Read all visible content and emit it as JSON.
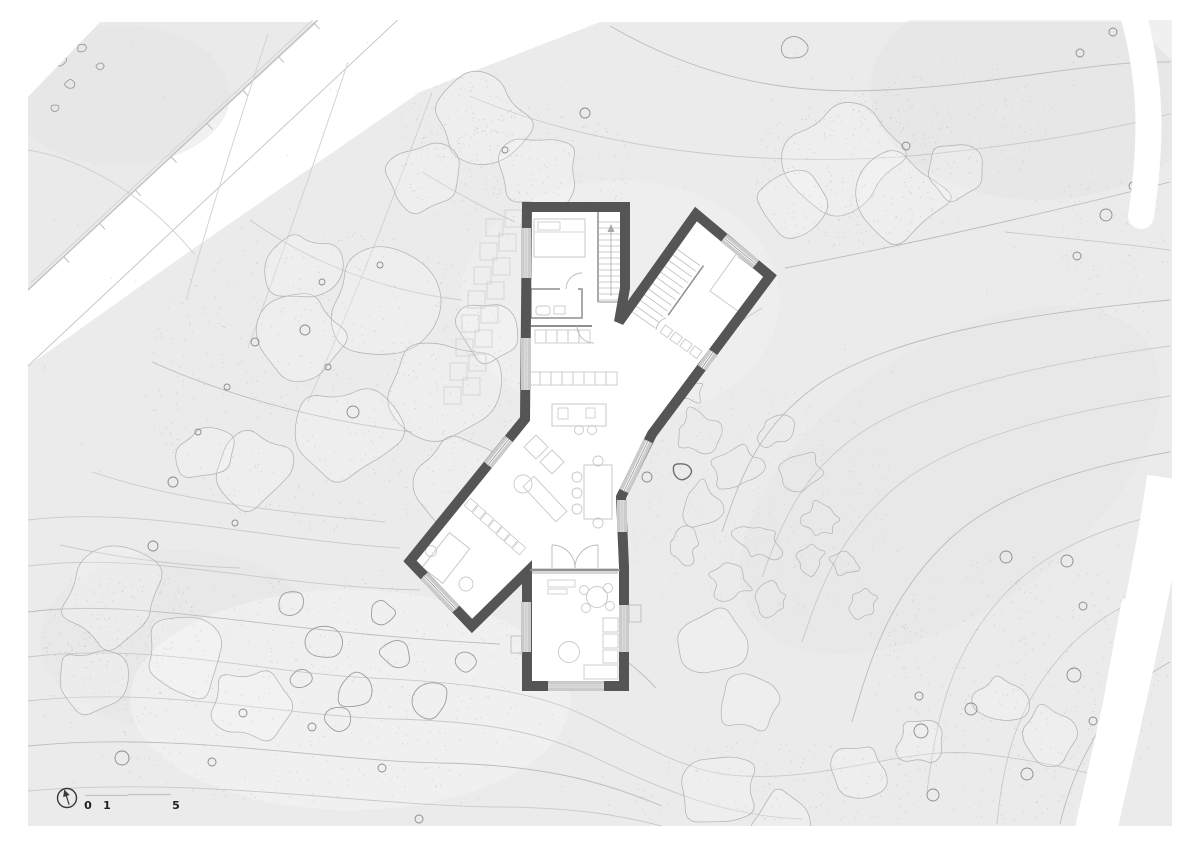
{
  "scale_bar": {
    "labels": [
      "0",
      "1",
      "5"
    ]
  },
  "icons": {
    "north_arrow": "north-arrow-icon"
  },
  "colors": {
    "paper": "#ffffff",
    "site": "#ebebeb",
    "site_dark": "#e3e3e3",
    "site_light": "#f3f3f3",
    "wall": "#555555",
    "window_band": "#cbcbcb",
    "window_glass": "#8f8f8f",
    "interior_line": "#8f8f8f",
    "furniture": "#c6cacc",
    "stair": "#bdbdbd",
    "contour": "#c9c9c9",
    "contour_dark": "#bcbcbc",
    "vegetation": "#b6b6b6",
    "rock": "#9c9c9c",
    "rock_dark": "#6f6f6f",
    "trunk": "#8b8b8b",
    "stipple": "#8f8f8f",
    "road_edge": "#bdbdbd",
    "arc": "#b9b9b9",
    "text": "#222222"
  }
}
